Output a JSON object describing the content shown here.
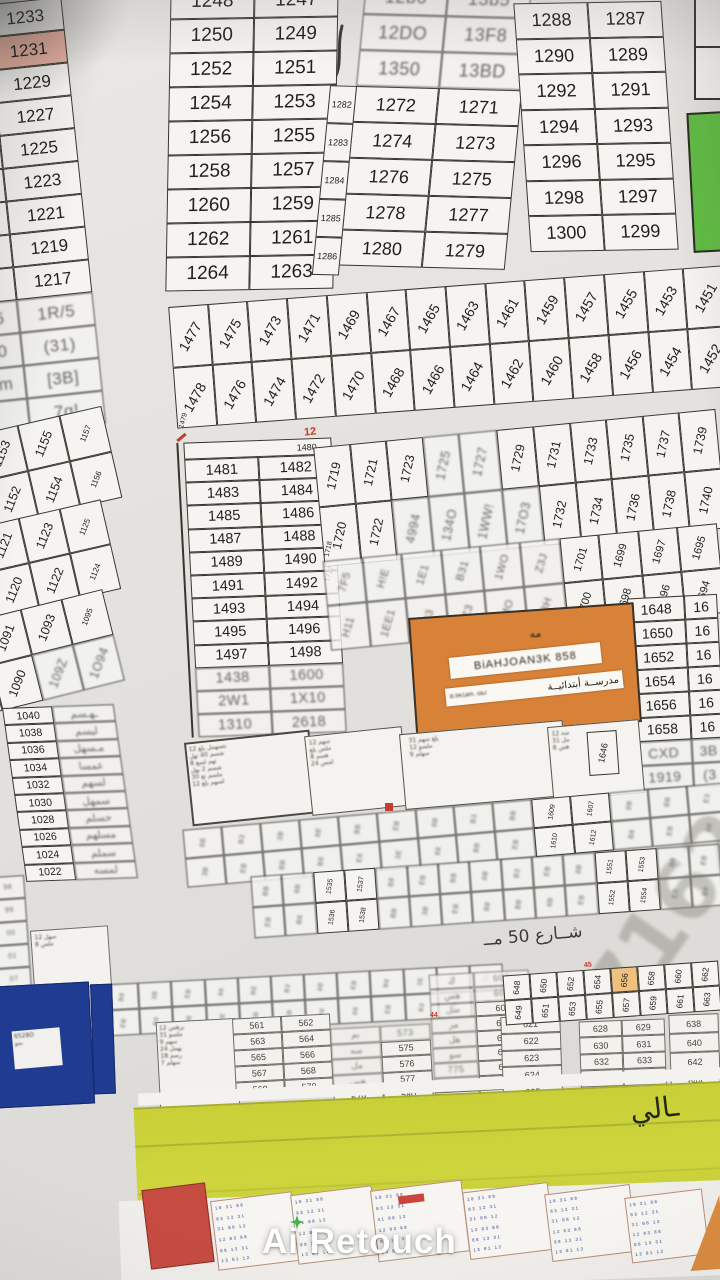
{
  "colors": {
    "pink_highlight": "#f2b5a4",
    "green_plot": "#5fbf3f",
    "orange_school": "#dc8033",
    "blue_plot": "#1e3c96",
    "yellow_band": "#cbd232",
    "red_block": "#cb4a3e",
    "orange_highlight": "#f0c27a",
    "watermark_sparkle": "#3cb54a"
  },
  "blocks": {
    "a": {
      "rows": [
        {
          "l": "",
          "r": "1233"
        },
        {
          "l": "",
          "r": "1231",
          "hl": 1
        },
        {
          "l": "",
          "r": "1229"
        },
        {
          "l": "3",
          "r": "1227"
        },
        {
          "l": "6",
          "r": "1225"
        },
        {
          "l": "4",
          "r": "1223"
        },
        {
          "l": "2",
          "r": "1221"
        },
        {
          "l": "20",
          "r": "1219"
        },
        {
          "l": "18",
          "r": "1217"
        },
        {
          "l": "16",
          "r": "1R/5",
          "b": 1
        },
        {
          "l": "J0",
          "r": "(31)",
          "b": 1
        },
        {
          "l": "cm",
          "r": "[3B]",
          "b": 1
        },
        {
          "l": "",
          "r": "7q!",
          "b": 1
        }
      ]
    },
    "b1250": {
      "rows": [
        [
          "1248",
          "1247"
        ],
        [
          "1250",
          "1249"
        ],
        [
          "1252",
          "1251"
        ],
        [
          "1254",
          "1253"
        ],
        [
          "1256",
          "1255"
        ],
        [
          "1258",
          "1257"
        ],
        [
          "1260",
          "1259"
        ],
        [
          "1262",
          "1261"
        ],
        [
          "1264",
          "1263"
        ]
      ]
    },
    "b1270": {
      "side": [
        "1282",
        "1283",
        "1284",
        "1285",
        "1286"
      ],
      "rows": [
        {
          "l": "12b6",
          "r": "13b5",
          "b": 1
        },
        {
          "l": "12DO",
          "r": "13F8",
          "b": 1
        },
        {
          "l": "1350",
          "r": "13BD",
          "b": 1
        },
        {
          "l": "1272",
          "r": "1271"
        },
        {
          "l": "1274",
          "r": "1273"
        },
        {
          "l": "1276",
          "r": "1275"
        },
        {
          "l": "1278",
          "r": "1277"
        },
        {
          "l": "1280",
          "r": "1279"
        }
      ]
    },
    "b1288": {
      "rows": [
        [
          "1288",
          "1287"
        ],
        [
          "1290",
          "1289"
        ],
        [
          "1292",
          "1291"
        ],
        [
          "1294",
          "1293"
        ],
        [
          "1296",
          "1295"
        ],
        [
          "1298",
          "1297"
        ],
        [
          "1300",
          "1299"
        ]
      ]
    },
    "band1470": {
      "label": "1479",
      "cols": [
        {
          "t": "1477",
          "b": "1478"
        },
        {
          "t": "1475",
          "b": "1476"
        },
        {
          "t": "1473",
          "b": "1474"
        },
        {
          "t": "1471",
          "b": "1472"
        },
        {
          "t": "1469",
          "b": "1470"
        },
        {
          "t": "1467",
          "b": "1468"
        },
        {
          "t": "1465",
          "b": "1466"
        },
        {
          "t": "1463",
          "b": "1464"
        },
        {
          "t": "1461",
          "b": "1462"
        },
        {
          "t": "1459",
          "b": "1460"
        },
        {
          "t": "1457",
          "b": "1458"
        },
        {
          "t": "1455",
          "b": "1456"
        },
        {
          "t": "1453",
          "b": "1454"
        },
        {
          "t": "1451",
          "b": "1452"
        }
      ]
    },
    "band1150": {
      "cols": [
        {
          "t": "1151",
          "b": "1150"
        },
        {
          "t": "1153",
          "b": "1152"
        },
        {
          "t": "1155",
          "b": "1154"
        },
        {
          "t": "1157",
          "sm": 1,
          "b": "1156",
          "smb": 1
        }
      ]
    },
    "band1118": {
      "cols": [
        {
          "t": "1119",
          "b": "1118"
        },
        {
          "t": "1121",
          "b": "1120"
        },
        {
          "t": "1123",
          "b": "1122"
        },
        {
          "t": "1125",
          "sm": 1,
          "b": "1124",
          "smb": 1
        }
      ]
    },
    "band1088": {
      "cols": [
        {
          "t": "1089",
          "b": "1088"
        },
        {
          "t": "1091",
          "b": "1090"
        },
        {
          "t": "1093",
          "b": "109Z",
          "gb": 1
        },
        {
          "t": "1095",
          "sm": 1,
          "b": "1O94",
          "gb": 1
        }
      ]
    },
    "b1481": {
      "header": "1480",
      "rows": [
        [
          "1481",
          "1482"
        ],
        [
          "1483",
          "1484"
        ],
        [
          "1485",
          "1486"
        ],
        [
          "1487",
          "1488"
        ],
        [
          "1489",
          "1490"
        ],
        [
          "1491",
          "1492"
        ],
        [
          "1493",
          "1494"
        ],
        [
          "1495",
          "1496"
        ],
        [
          "1497",
          "1498"
        ],
        {
          "l": "1438",
          "r": "1600",
          "b": 1
        },
        {
          "l": "2W1",
          "r": "1X10",
          "b": 1
        },
        {
          "l": "1310",
          "r": "2618",
          "b": 1
        }
      ]
    },
    "band1719": {
      "label": "1718",
      "cols": [
        {
          "t": "1719",
          "b": "1720"
        },
        {
          "t": "1721",
          "b": "1722"
        },
        {
          "t": "1723",
          "b": "4994",
          "gb": 1
        },
        {
          "t": "1725",
          "gt": 1,
          "b": "134O",
          "gb": 1
        },
        {
          "t": "1727",
          "gt": 1,
          "b": "1WW!",
          "gb": 1
        },
        {
          "t": "1729",
          "b": "17O3",
          "gb": 1
        },
        {
          "t": "1731",
          "b": "1732"
        },
        {
          "t": "1733",
          "b": "1734"
        },
        {
          "t": "1735",
          "b": "1736"
        },
        {
          "t": "1737",
          "b": "1738"
        },
        {
          "t": "1739",
          "b": "1740"
        }
      ]
    },
    "band1701": {
      "label": "1717",
      "cols": [
        {
          "t": "7F5",
          "gt": 1,
          "b": "H11",
          "gb": 1
        },
        {
          "t": "H!E",
          "gt": 1,
          "b": "1EE1",
          "gb": 1
        },
        {
          "t": "1E1",
          "gt": 1,
          "b": "Z33",
          "gb": 1
        },
        {
          "t": "B31",
          "gt": 1,
          "b": "OZ3",
          "gb": 1
        },
        {
          "t": "1WO",
          "gt": 1,
          "b": "1MO",
          "gb": 1
        },
        {
          "t": "Z3J",
          "gt": 1,
          "b": "73H",
          "gb": 1
        },
        {
          "t": "1701",
          "b": "1700"
        },
        {
          "t": "1699",
          "b": "1698"
        },
        {
          "t": "1697",
          "b": "1696"
        },
        {
          "t": "1695",
          "b": "1694"
        }
      ]
    },
    "col1648": {
      "rows": [
        [
          "1648",
          "16"
        ],
        [
          "1650",
          "16"
        ],
        [
          "1652",
          "16"
        ],
        [
          "1654",
          "16"
        ],
        [
          "1656",
          "16"
        ],
        [
          "1658",
          "16"
        ],
        {
          "l": "CXD",
          "r": "3B",
          "b": 1
        },
        {
          "l": "1919",
          "r": "(3",
          "b": 1
        }
      ]
    },
    "school": {
      "mark": "مه",
      "line1": "BiAHJOAN3K 858",
      "line1b": "ByRWJ5B",
      "line2": "مدرســة أبتدائيــة",
      "line2_prefix": "B.9e1am. oaJ"
    },
    "col1040": {
      "rows": [
        {
          "l": "1040",
          "r": "ـهـسم",
          "br": 1
        },
        {
          "l": "1038",
          "r": "ليسم",
          "br": 1
        },
        {
          "l": "1036",
          "r": "مـسهل",
          "br": 1
        },
        {
          "l": "1034",
          "r": "عمسا",
          "br": 1
        },
        {
          "l": "1032",
          "r": "لسهم",
          "br": 1
        },
        {
          "l": "1030",
          "r": "سمهل",
          "br": 1
        },
        {
          "l": "1028",
          "r": "حسلم",
          "br": 1
        },
        {
          "l": "1026",
          "r": "مسلهم",
          "br": 1
        },
        {
          "l": "1024",
          "r": "سملم",
          "br": 1
        },
        {
          "l": "1022",
          "r": "لمسه",
          "br": 1
        }
      ]
    },
    "tA": {
      "lines": [
        "نتسهمل يلع 12",
        "شسم 40 تهل",
        "تهم لسع 8",
        "شسم 2 يهل",
        "ملسم تع 30",
        "لسهم يلع 12"
      ]
    },
    "tB": {
      "lines": [
        "سهم 12",
        "ملس يلع",
        "هسم 8",
        "لمس 24"
      ]
    },
    "tC": {
      "lines": [
        "يلع سهم 31",
        "ملسو 12",
        "سهلم 9"
      ]
    },
    "tD": {
      "lines": [
        "سه 12",
        "مل 31",
        "هس 8"
      ]
    },
    "cell1646": "1646",
    "s1": {
      "r1": [
        "8B",
        "B3",
        "3B",
        "8E",
        "BB",
        "EB",
        "8B",
        "B3",
        "BB",
        {
          "t": "1609"
        },
        {
          "t": "1607"
        },
        "8B",
        "BB",
        "E3"
      ],
      "r2": [
        "3B",
        "EB",
        "BB",
        "B8",
        "E8",
        "3E",
        "88",
        "BB",
        "EB",
        {
          "t": "1610"
        },
        {
          "t": "1612"
        },
        "B8",
        "EB",
        "88"
      ]
    },
    "s2": {
      "r1": [
        "BB",
        "8B",
        {
          "t": "1535"
        },
        {
          "t": "1537"
        },
        "B8",
        "EB",
        "BB",
        "8B",
        "B3",
        "EB",
        "8B",
        {
          "t": "1551"
        },
        {
          "t": "1553"
        },
        "B8",
        "EB"
      ],
      "r2": [
        "EB",
        "B8",
        {
          "t": "1536"
        },
        {
          "t": "1538"
        },
        "BB",
        "3B",
        "EB",
        "B8",
        "BB",
        "8B",
        "EB",
        {
          "t": "1552"
        },
        {
          "t": "1554"
        },
        "EB",
        "B8"
      ]
    },
    "s3": {
      "r1": [
        "B8",
        "3B",
        "EB",
        "88",
        "BE",
        "B3",
        "8B",
        "EB",
        "B8",
        "3E",
        "BB",
        "8E"
      ],
      "r2": [
        "EB",
        "B8",
        "8B",
        "BE",
        "3B",
        "EB",
        "B8",
        "88",
        "EB",
        "B3",
        "8B",
        "BB"
      ]
    },
    "s648": {
      "r1": [
        {
          "t": "648"
        },
        {
          "t": "650"
        },
        {
          "t": "652"
        },
        {
          "t": "654"
        },
        {
          "t": "656",
          "hl": 1
        },
        {
          "t": "658"
        },
        {
          "t": "660"
        },
        {
          "t": "662"
        }
      ],
      "r2": [
        {
          "t": "649"
        },
        {
          "t": "651"
        },
        {
          "t": "653"
        },
        {
          "t": "655"
        },
        {
          "t": "657"
        },
        {
          "t": "659"
        },
        {
          "t": "661"
        },
        {
          "t": "663"
        }
      ]
    },
    "leftsm": {
      "list": [
        {
          "t": "98",
          "g": 1
        },
        {
          "t": "99",
          "g": 1
        },
        {
          "t": "00",
          "g": 1
        },
        {
          "t": "01",
          "g": 1
        },
        {
          "t": "07",
          "g": 1
        }
      ]
    },
    "leftsm2": {
      "lines": [
        "سهل 12",
        "ملس 8"
      ]
    },
    "blue": {
      "lines": [
        "6528O",
        "ىمو"
      ]
    },
    "g561": {
      "lines": [
        "يرهس 12",
        "ملسو 31",
        "سهم 9",
        "يهمل 24",
        "رسم 18",
        "سهلم 7"
      ]
    },
    "t561": {
      "rows": [
        [
          "561",
          "562"
        ],
        [
          "563",
          "564"
        ],
        [
          "565",
          "566"
        ],
        [
          "567",
          "568"
        ],
        [
          "569",
          "570"
        ]
      ]
    },
    "t571": {
      "rows": [
        {
          "l": "ىم",
          "r": "573",
          "bl": 1,
          "br": 1
        },
        {
          "l": "سه",
          "r": "575",
          "bl": 1
        },
        {
          "l": "مل",
          "r": "576",
          "bl": 1
        },
        {
          "l": "هس",
          "r": "577",
          "bl": 1
        },
        {
          "l": "579",
          "r": "580"
        }
      ]
    },
    "t604": {
      "rows": [
        {
          "l": "ك",
          "r": "604",
          "bl": 1,
          "br": 1
        },
        {
          "l": "هس",
          "r": "606",
          "bl": 1,
          "br": 1
        },
        {
          "l": "سل",
          "r": "608",
          "bl": 1
        },
        {
          "l": "مر",
          "r": "610",
          "bl": 1
        },
        {
          "l": "هل",
          "r": "612",
          "bl": 1
        },
        {
          "l": "سو",
          "r": "614",
          "bl": 1
        },
        {
          "l": "775",
          "r": "616",
          "bl": 1
        },
        {
          "l": "بع",
          "r": "618",
          "bl": 1
        },
        {
          "l": "619",
          "r": "620"
        }
      ]
    },
    "c621": {
      "list": [
        "621",
        "622",
        "623",
        "624",
        "625",
        "626"
      ]
    },
    "t628": {
      "rows": [
        [
          "628",
          "629"
        ],
        [
          "630",
          "631"
        ],
        [
          "632",
          "633"
        ],
        [
          "634",
          "635"
        ],
        [
          "636",
          "637"
        ]
      ]
    },
    "c638": {
      "list": [
        "638",
        "640",
        "642",
        "644",
        "646"
      ]
    },
    "street": "شــارع 50 مــ",
    "pencil": "7162",
    "yellow_label": "ـالي",
    "red": {
      "r12": "12",
      "r44": "44",
      "r45": "45"
    }
  },
  "garble_mini": [
    "18 31 88",
    "83 12 31",
    "31 88 12",
    "12 83 88",
    "88 13 31",
    "13 81 12"
  ],
  "watermark": {
    "label": "Ai Retouch"
  }
}
